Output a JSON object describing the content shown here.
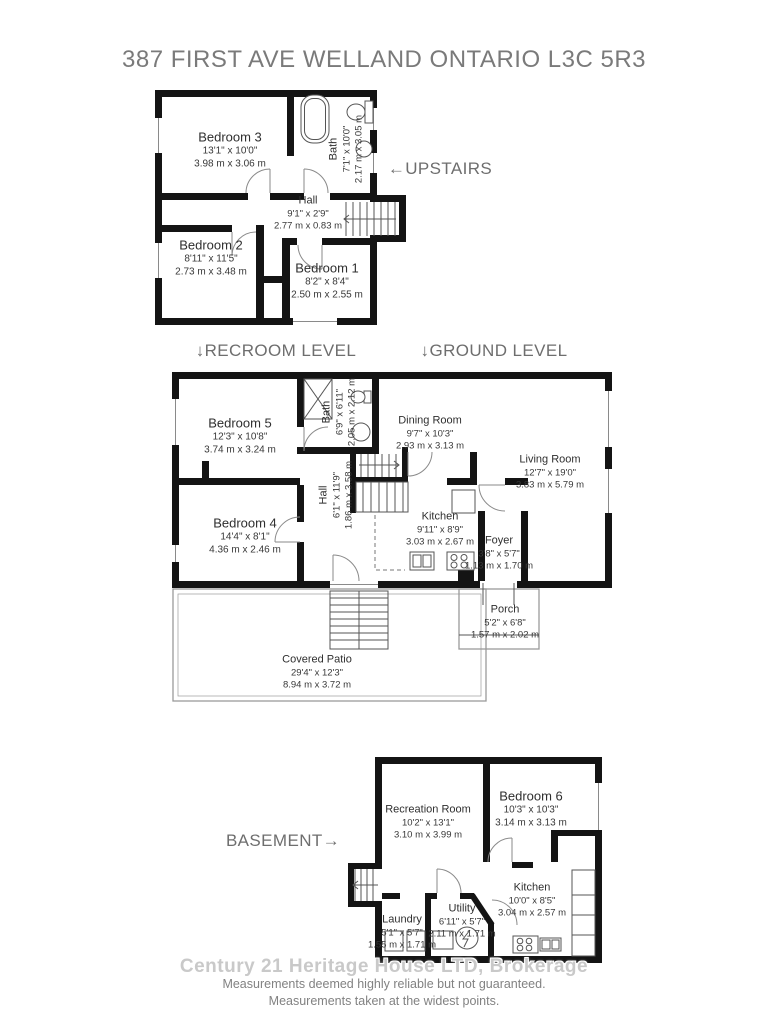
{
  "title": "387 FIRST AVE WELLAND ONTARIO L3C 5R3",
  "levels": {
    "upstairs": "←UPSTAIRS",
    "recroom": "↓RECROOM LEVEL",
    "ground": "↓GROUND LEVEL",
    "basement": "BASEMENT→"
  },
  "rooms": {
    "bedroom3": {
      "name": "Bedroom 3",
      "imperial": "13'1\" x 10'0\"",
      "metric": "3.98 m x 3.06 m"
    },
    "bath_up": {
      "name": "Bath",
      "imperial": "7'1\" x 10'0\"",
      "metric": "2.17 m x 3.05 m"
    },
    "hall_up": {
      "name": "Hall",
      "imperial": "9'1\" x 2'9\"",
      "metric": "2.77 m x 0.83 m"
    },
    "bedroom2": {
      "name": "Bedroom 2",
      "imperial": "8'11\" x 11'5\"",
      "metric": "2.73 m x 3.48 m"
    },
    "bedroom1": {
      "name": "Bedroom 1",
      "imperial": "8'2\" x 8'4\"",
      "metric": "2.50 m x 2.55 m"
    },
    "bedroom5": {
      "name": "Bedroom 5",
      "imperial": "12'3\" x 10'8\"",
      "metric": "3.74 m x 3.24 m"
    },
    "bath_mid": {
      "name": "Bath",
      "imperial": "6'9\" x 6'11\"",
      "metric": "2.05 m x 2.12 m"
    },
    "dining": {
      "name": "Dining Room",
      "imperial": "9'7\" x 10'3\"",
      "metric": "2.93 m x 3.13 m"
    },
    "living": {
      "name": "Living Room",
      "imperial": "12'7\" x 19'0\"",
      "metric": "3.83 m x 5.79 m"
    },
    "hall_mid": {
      "name": "Hall",
      "imperial": "6'1\" x 11'9\"",
      "metric": "1.86 m x 3.58 m"
    },
    "kitchen_mid": {
      "name": "Kitchen",
      "imperial": "9'11\" x 8'9\"",
      "metric": "3.03 m x 2.67 m"
    },
    "foyer": {
      "name": "Foyer",
      "imperial": "3'8\" x 5'7\"",
      "metric": "1.13 m x 1.70 m"
    },
    "bedroom4": {
      "name": "Bedroom 4",
      "imperial": "14'4\" x 8'1\"",
      "metric": "4.36 m x 2.46 m"
    },
    "porch": {
      "name": "Porch",
      "imperial": "5'2\" x 6'8\"",
      "metric": "1.57 m x 2.02 m"
    },
    "patio": {
      "name": "Covered Patio",
      "imperial": "29'4\" x 12'3\"",
      "metric": "8.94 m x 3.72 m"
    },
    "recreation": {
      "name": "Recreation Room",
      "imperial": "10'2\" x 13'1\"",
      "metric": "3.10 m x 3.99 m"
    },
    "bedroom6": {
      "name": "Bedroom 6",
      "imperial": "10'3\" x 10'3\"",
      "metric": "3.14 m x 3.13 m"
    },
    "kitchen_bsmt": {
      "name": "Kitchen",
      "imperial": "10'0\" x 8'5\"",
      "metric": "3.04 m x 2.57 m"
    },
    "utility": {
      "name": "Utility",
      "imperial": "6'11\" x 5'7\"",
      "metric": "2.11 m x 1.71 m"
    },
    "laundry": {
      "name": "Laundry",
      "imperial": "5'1\" x 5'7\"",
      "metric": "1.55 m x 1.71 m"
    }
  },
  "footer": {
    "watermark": "Century 21 Heritage House LTD, Brokerage",
    "line1": "Measurements deemed highly reliable but not guaranteed.",
    "line2": "Measurements taken at the widest points."
  },
  "colors": {
    "wall": "#141414",
    "label_text": "#2f2f2f",
    "heading_text": "#6e6e6e",
    "watermark": "#c9c9c9",
    "footer_text": "#828282"
  }
}
